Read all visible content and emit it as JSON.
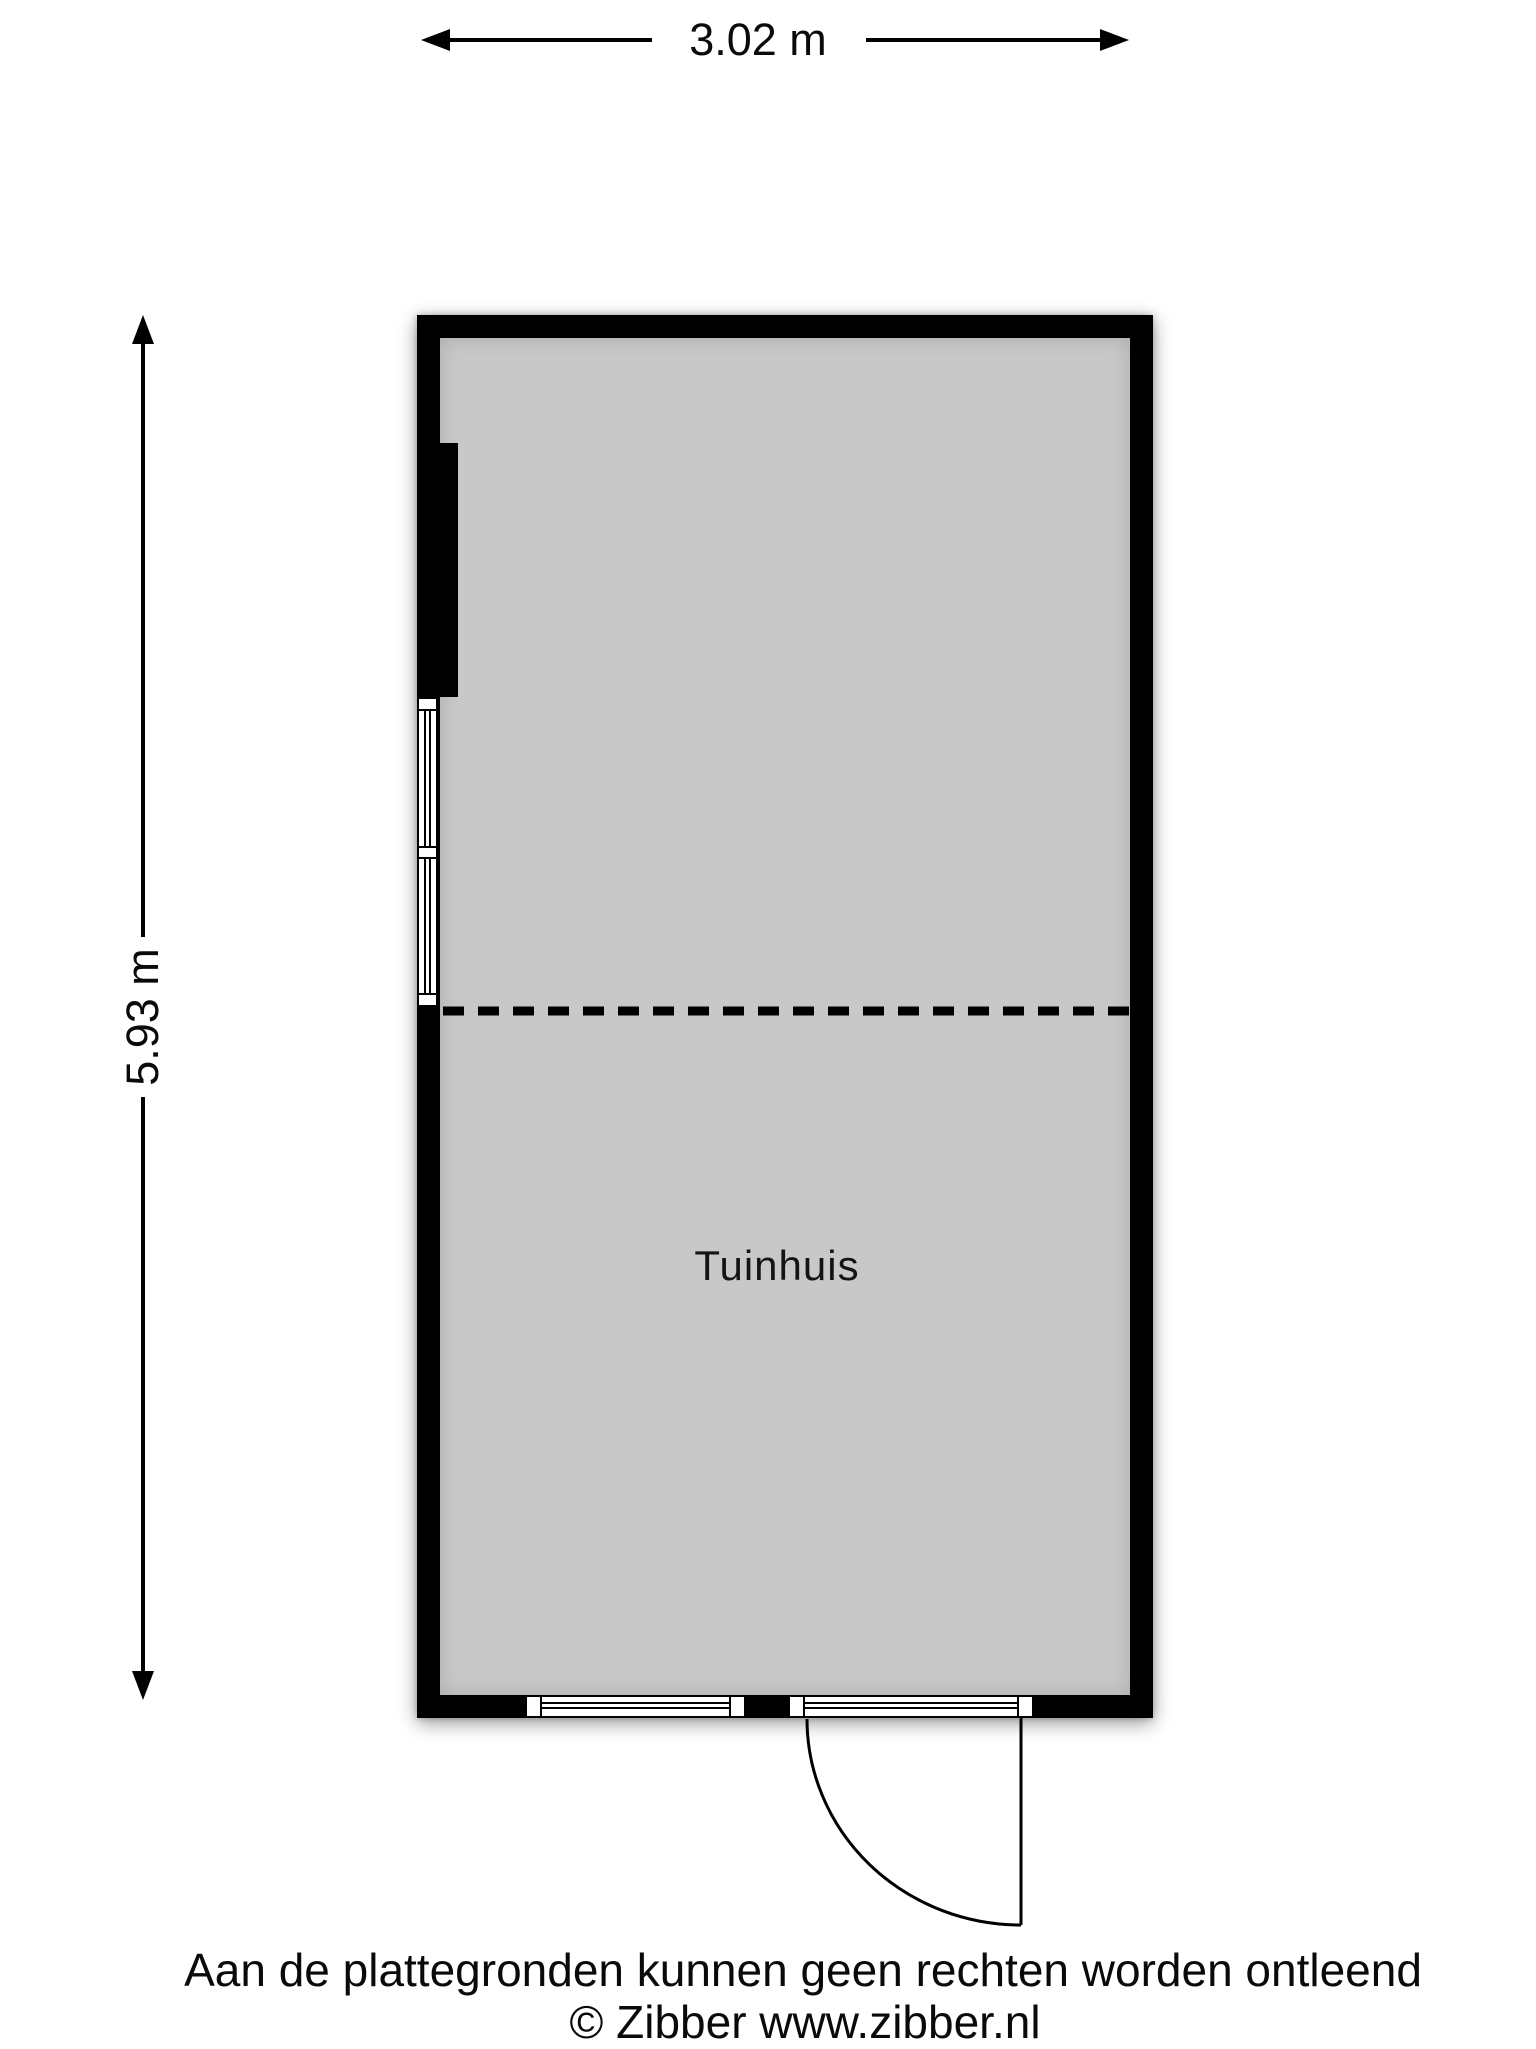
{
  "plan": {
    "room": {
      "label": "Tuinhuis"
    },
    "dimensions": {
      "width": "3.02 m",
      "height": "5.93 m"
    },
    "colors": {
      "wall": "#000000",
      "floor": "#c8c8c8",
      "line": "#000000",
      "background": "#ffffff"
    },
    "footer": {
      "disclaimer": "Aan de plattegronden kunnen geen rechten worden ontleend",
      "copyright": "© Zibber www.zibber.nl"
    }
  }
}
